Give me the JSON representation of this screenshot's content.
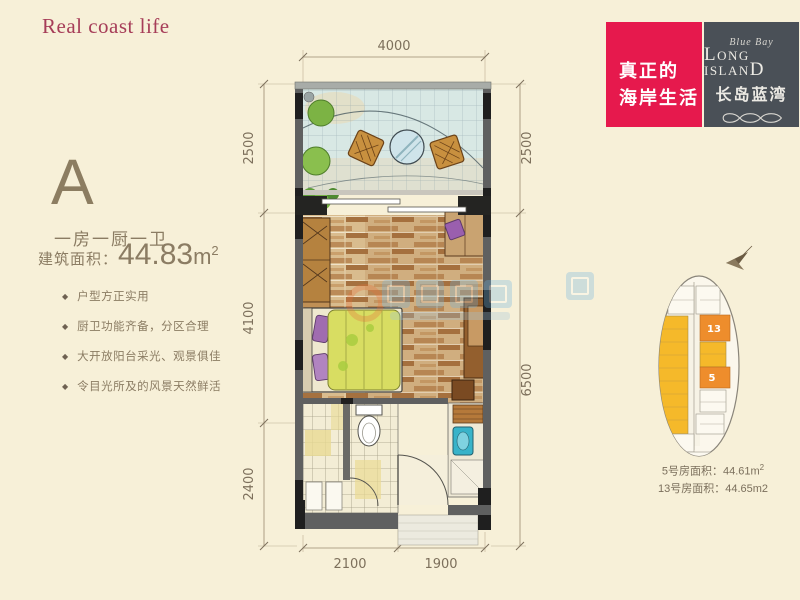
{
  "page": {
    "tagline": "Real coast life",
    "background_color": "#f7f0d8"
  },
  "unit_info": {
    "type_letter": "A",
    "layout": "一房一厨一卫",
    "area_label": "建筑面积：",
    "area_value": "44.83",
    "area_unit_base": "m",
    "area_unit_sup": "2",
    "features": [
      "户型方正实用",
      "厨卫功能齐备，分区合理",
      "大开放阳台采光、观景俱佳",
      "令目光所及的风景天然鲜活"
    ]
  },
  "brand": {
    "slogan_line1": "真正的",
    "slogan_line2": "海岸生活",
    "slogan_bg": "#e6194d",
    "logo_bg": "#4a5057",
    "logo_script": "Blue Bay",
    "logo_en_l": "L",
    "logo_en_mid": "ONG ISLAN",
    "logo_en_d": "D",
    "logo_cn": "长岛蓝湾"
  },
  "keyplan": {
    "unit13_label": "13",
    "unit5_label": "5",
    "unit_yellow": "#f5b92a",
    "highlight_orange": "#ee8d2c",
    "caption1_pre": "5号房面积：44.61m",
    "caption1_sup": "2",
    "caption2": "13号房面积：44.65m2"
  },
  "dims": {
    "top": "4000",
    "left_top": "2500",
    "left_mid": "4100",
    "left_bottom": "2400",
    "right_top": "2500",
    "right_main": "6500",
    "bottom_left": "2100",
    "bottom_right": "1900"
  }
}
